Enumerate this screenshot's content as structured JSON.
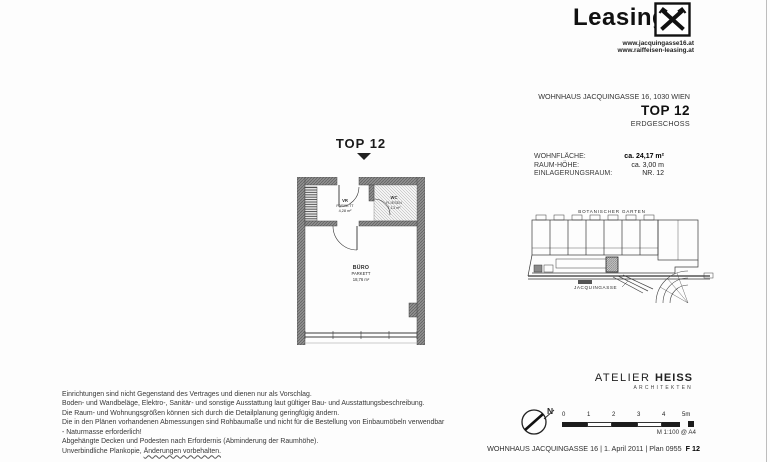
{
  "colors": {
    "ink": "#1a1a1a",
    "scan_gray": "#3d3d3d",
    "wall_gray": "#8f8f8f"
  },
  "brand": {
    "name": "Leasing",
    "logo": "raiffeisen-gable-cross-icon",
    "urls": [
      "www.jacquingasse16.at",
      "www.raiffeisen-leasing.at"
    ]
  },
  "property": {
    "building": "WOHNHAUS JACQUINGASSE 16, 1030 WIEN",
    "unit": "TOP 12",
    "floor": "ERDGESCHOSS"
  },
  "details": {
    "rows": [
      {
        "label": "WOHNFLÄCHE:",
        "value": "ca. 24,17 m²"
      },
      {
        "label": "RAUM-HÖHE:",
        "value": "ca. 3,00 m"
      },
      {
        "label": "EINLAGERUNGSRAUM:",
        "value": "NR. 12"
      }
    ]
  },
  "floorplan": {
    "title": "TOP 12",
    "rooms": {
      "vr": {
        "name": "VR",
        "finish": "PARKETT",
        "area": "4,28 m²"
      },
      "wc": {
        "name": "WC",
        "finish": "FLIESEN",
        "area": "1,13 m²"
      },
      "buero": {
        "name": "BÜRO",
        "finish": "PARKETT",
        "area": "18,76 m²"
      }
    }
  },
  "siteplan": {
    "garden_label": "BOTANISCHER GARTEN",
    "street_label": "JACQUINGASSE"
  },
  "notes": {
    "lines": [
      "Einrichtungen sind nicht Gegenstand des Vertrages und dienen nur als Vorschlag.",
      "Boden- und Wandbeläge, Elektro-, Sanitär- und sonstige Ausstattung laut gültiger Bau- und Ausstattungsbeschreibung.",
      "Die Raum- und Wohnungsgrößen können sich durch die Detailplanung geringfügig ändern.",
      "Die in den Plänen vorhandenen Abmessungen sind Rohbaumaße und nicht für die Bestellung von Einbaumöbeln verwendbar",
      "- Naturmasse erforderlich!",
      "Abgehängte Decken und Podesten nach Erfordernis (Abminderung der Raumhöhe)."
    ],
    "final": {
      "part1": "Unverbindliche Plankopie, ",
      "part2": "Änderungen vorbehalten."
    }
  },
  "architect": {
    "name_regular": "ATELIER ",
    "name_bold": "HEISS",
    "subtitle": "ARCHITEKTEN"
  },
  "legend": {
    "north": "N",
    "ticks": [
      "0",
      "1",
      "2",
      "3",
      "4",
      "5m"
    ],
    "scale": "M 1:100 @ A4"
  },
  "footer": {
    "text": "WOHNHAUS JACQUINGASSE 16 | 1. April 2011 | Plan 0955",
    "code": "F 12"
  }
}
